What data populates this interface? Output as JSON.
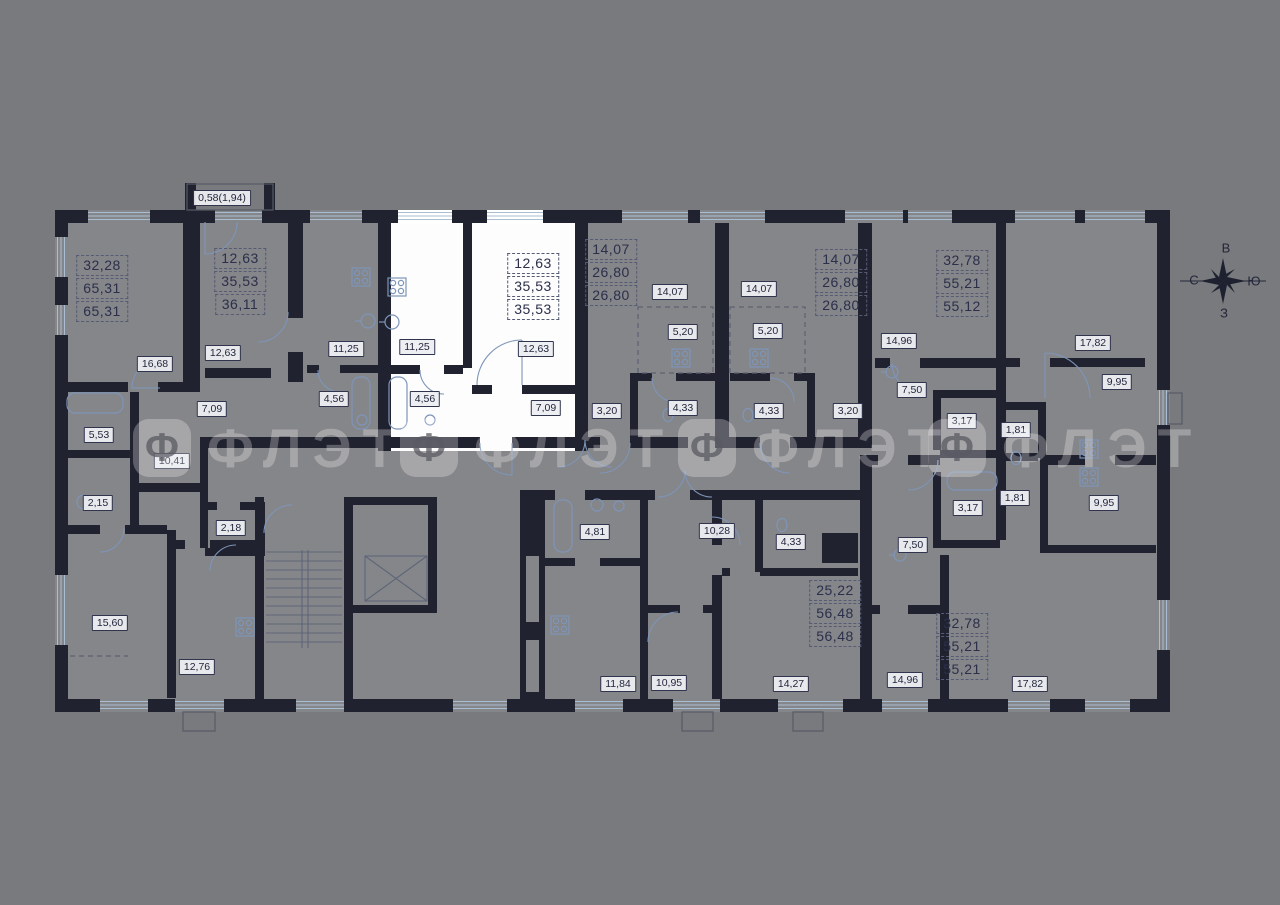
{
  "palette": {
    "background": "#797a7d",
    "floor": "#85868a",
    "floor_highlight": "#ffffff",
    "wall": "#20222f",
    "fixture_line": "#7e95b8",
    "window_line": "#a9bed2",
    "label_text": "#1f2338",
    "label_bg": "#eceef2",
    "dashed_border": "#565b74",
    "watermark": "rgba(255,255,255,0.27)"
  },
  "watermark": {
    "icon_letter": "Ф",
    "text": "ФЛЭТ",
    "positions": [
      {
        "x": 133,
        "y": 419
      },
      {
        "x": 400,
        "y": 419
      },
      {
        "x": 678,
        "y": 419
      },
      {
        "x": 928,
        "y": 419
      }
    ]
  },
  "compass": {
    "top": "В",
    "left": "С",
    "right": "Ю",
    "bottom": "З"
  },
  "apartments": [
    {
      "values": [
        "32,28",
        "65,31",
        "65,31"
      ],
      "x": 102,
      "y": 255,
      "highlighted": false
    },
    {
      "values": [
        "12,63",
        "35,53",
        "36,11"
      ],
      "x": 240,
      "y": 248,
      "highlighted": false
    },
    {
      "values": [
        "12,63",
        "35,53",
        "35,53"
      ],
      "x": 533,
      "y": 253,
      "highlighted": true
    },
    {
      "values": [
        "14,07",
        "26,80",
        "26,80"
      ],
      "x": 611,
      "y": 239,
      "highlighted": false
    },
    {
      "values": [
        "14,07",
        "26,80",
        "26,80"
      ],
      "x": 841,
      "y": 249,
      "highlighted": false
    },
    {
      "values": [
        "32,78",
        "55,21",
        "55,12"
      ],
      "x": 962,
      "y": 250,
      "highlighted": false
    },
    {
      "values": [
        "25,22",
        "56,48",
        "56,48"
      ],
      "x": 835,
      "y": 580,
      "highlighted": false
    },
    {
      "values": [
        "32,78",
        "55,21",
        "55,21"
      ],
      "x": 962,
      "y": 613,
      "highlighted": false
    }
  ],
  "rooms": [
    {
      "t": "0,58(1,94)",
      "x": 222,
      "y": 198
    },
    {
      "t": "16,68",
      "x": 155,
      "y": 364
    },
    {
      "t": "12,63",
      "x": 223,
      "y": 353
    },
    {
      "t": "7,09",
      "x": 212,
      "y": 409
    },
    {
      "t": "5,53",
      "x": 99,
      "y": 435
    },
    {
      "t": "11,25",
      "x": 346,
      "y": 349
    },
    {
      "t": "4,56",
      "x": 334,
      "y": 399
    },
    {
      "t": "11,25",
      "x": 417,
      "y": 347
    },
    {
      "t": "12,63",
      "x": 536,
      "y": 349
    },
    {
      "t": "4,56",
      "x": 425,
      "y": 399
    },
    {
      "t": "7,09",
      "x": 546,
      "y": 408
    },
    {
      "t": "14,07",
      "x": 670,
      "y": 292
    },
    {
      "t": "5,20",
      "x": 683,
      "y": 332
    },
    {
      "t": "3,20",
      "x": 607,
      "y": 411
    },
    {
      "t": "4,33",
      "x": 683,
      "y": 408
    },
    {
      "t": "14,07",
      "x": 759,
      "y": 289
    },
    {
      "t": "5,20",
      "x": 768,
      "y": 331
    },
    {
      "t": "4,33",
      "x": 769,
      "y": 411
    },
    {
      "t": "3,20",
      "x": 848,
      "y": 411
    },
    {
      "t": "14,96",
      "x": 899,
      "y": 341
    },
    {
      "t": "7,50",
      "x": 912,
      "y": 390
    },
    {
      "t": "3,17",
      "x": 962,
      "y": 421
    },
    {
      "t": "1,81",
      "x": 1016,
      "y": 430
    },
    {
      "t": "17,82",
      "x": 1093,
      "y": 343
    },
    {
      "t": "9,95",
      "x": 1117,
      "y": 382
    },
    {
      "t": "10,41",
      "x": 172,
      "y": 461
    },
    {
      "t": "2,15",
      "x": 98,
      "y": 503
    },
    {
      "t": "2,18",
      "x": 231,
      "y": 528
    },
    {
      "t": "15,60",
      "x": 110,
      "y": 623
    },
    {
      "t": "12,76",
      "x": 197,
      "y": 667
    },
    {
      "t": "4,81",
      "x": 595,
      "y": 532
    },
    {
      "t": "10,28",
      "x": 717,
      "y": 531
    },
    {
      "t": "4,33",
      "x": 791,
      "y": 542
    },
    {
      "t": "11,84",
      "x": 618,
      "y": 684
    },
    {
      "t": "10,95",
      "x": 669,
      "y": 683
    },
    {
      "t": "14,27",
      "x": 791,
      "y": 684
    },
    {
      "t": "1,81",
      "x": 1015,
      "y": 498
    },
    {
      "t": "3,17",
      "x": 968,
      "y": 508
    },
    {
      "t": "9,95",
      "x": 1104,
      "y": 503
    },
    {
      "t": "7,50",
      "x": 913,
      "y": 545
    },
    {
      "t": "14,96",
      "x": 905,
      "y": 680
    },
    {
      "t": "17,82",
      "x": 1030,
      "y": 684
    }
  ]
}
